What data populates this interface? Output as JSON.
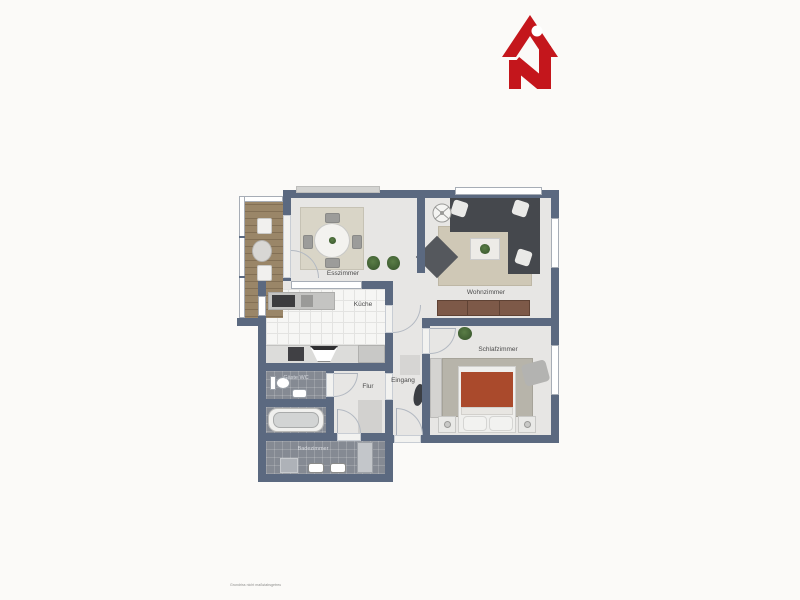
{
  "logo": {
    "icon": "house-with-letter-n",
    "color": "#c4161c"
  },
  "floor_plan": {
    "rooms": {
      "esszimmer": "Esszimmer",
      "kueche": "Küche",
      "wohnzimmer": "Wohnzimmer",
      "schlafzimmer": "Schlafzimmer",
      "flur": "Flur",
      "eingang": "Eingang",
      "gaeste_wc": "Gäste WC",
      "badezimmer": "Badezimmer"
    },
    "colors": {
      "wall": "#5b6980",
      "floor_light": "#e7e6e4",
      "tile_dark": "#858a93",
      "kitchen_tile": "#f6f6f4",
      "balcony_deck": "#9a8668",
      "bed_duvet": "#aa4a2c",
      "sofa": "#45484d"
    }
  },
  "fine_print": "Grundriss nicht maßstabsgetreu"
}
